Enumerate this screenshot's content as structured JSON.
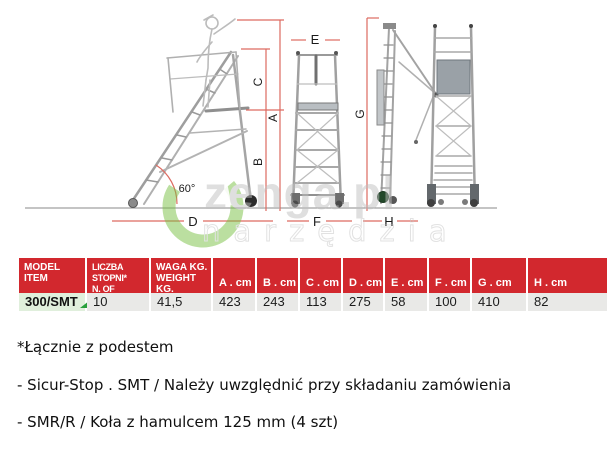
{
  "diagram": {
    "labels": {
      "a": "A",
      "b": "B",
      "c": "C",
      "d": "D",
      "e": "E",
      "f": "F",
      "g": "G",
      "h": "H",
      "angle": "60°"
    }
  },
  "watermark": {
    "line1": "zenga.pl",
    "line2": "narzędzia"
  },
  "table": {
    "columns": [
      {
        "l1": "MODEL",
        "l2": "ITEM"
      },
      {
        "l1": "LICZBA STOPNI*",
        "l2": "N. OF RUNGS*"
      },
      {
        "l1": "WAGA KG.",
        "l2": "WEIGHT KG."
      },
      {
        "l1": "A . cm",
        "l2": ""
      },
      {
        "l1": "B . cm",
        "l2": ""
      },
      {
        "l1": "C . cm",
        "l2": ""
      },
      {
        "l1": "D . cm",
        "l2": ""
      },
      {
        "l1": "E . cm",
        "l2": ""
      },
      {
        "l1": "F . cm",
        "l2": ""
      },
      {
        "l1": "G . cm",
        "l2": ""
      },
      {
        "l1": "H . cm",
        "l2": ""
      }
    ],
    "values": [
      "300/SMT",
      "10",
      "41,5",
      "423",
      "243",
      "113",
      "275",
      "58",
      "100",
      "410",
      "82"
    ]
  },
  "notes": [
    "*Łącznie z podestem",
    "- Sicur-Stop . SMT / Należy uwzględnić przy składaniu zamówienia",
    "- SMR/R / Koła z hamulcem 125 mm (4 szt)"
  ],
  "colors": {
    "table_header_red": "#d2282e",
    "dimension_line_red": "#dd6a60",
    "flag_green": "#28a03c",
    "watermark_green": "#79c143",
    "row_gray": "#e9e9e7",
    "model_cell_green": "#e0efdc"
  }
}
